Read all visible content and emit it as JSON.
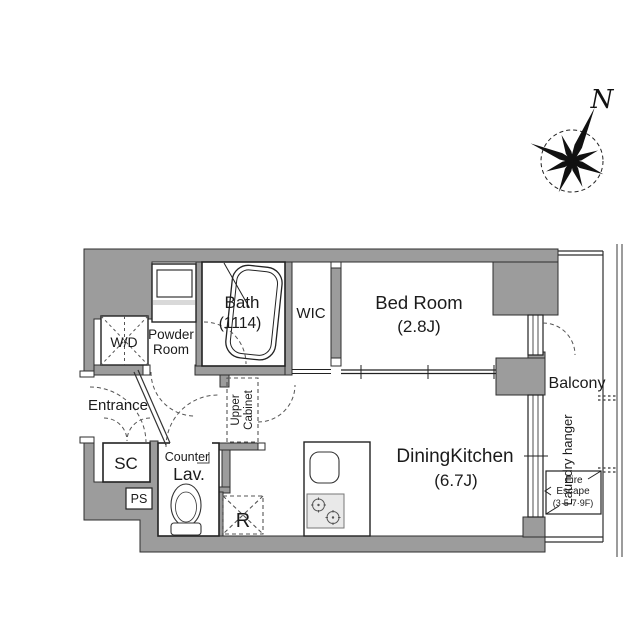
{
  "labels": {
    "compass_north": "N",
    "bath": "Bath",
    "bath_size": "(1114)",
    "wic": "WIC",
    "bedroom": "Bed Room",
    "bedroom_size": "(2.8J)",
    "powder_1": "Powder",
    "powder_2": "Room",
    "wd": "W/D",
    "entrance": "Entrance",
    "sc": "SC",
    "ps": "PS",
    "counter": "Counter",
    "lav": "Lav.",
    "upper_cabinet_1": "Upper",
    "upper_cabinet_2": "Cabinet",
    "fridge": "R",
    "dk": "DiningKitchen",
    "dk_size": "(6.7J)",
    "balcony": "Balcony",
    "laundry_hanger": "Laundry hanger",
    "fire_escape_1": "Fire",
    "fire_escape_2": "Escape",
    "fire_escape_3": "(3·5·7·9F)"
  },
  "colors": {
    "wall": "#9c9c9c",
    "line": "#2e2e2e",
    "stove_fill": "#e9e9e9"
  }
}
